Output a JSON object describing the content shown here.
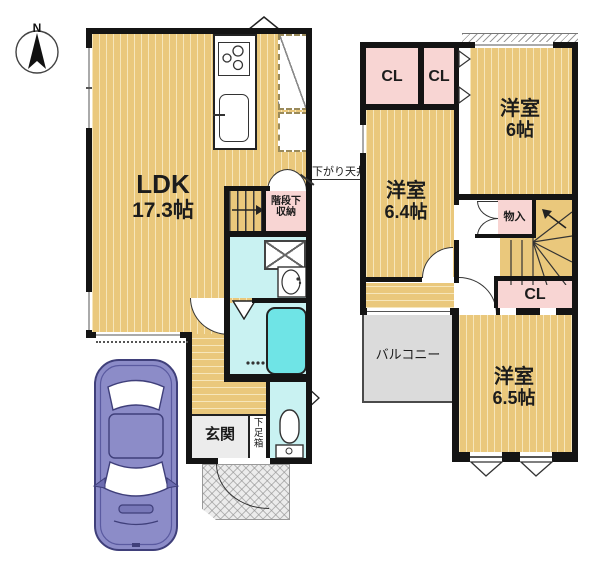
{
  "compass": {
    "north_label": "N"
  },
  "floor1": {
    "ldk": {
      "name": "LDK",
      "area": "17.3帖"
    },
    "lowered_ceiling_note": "下がり天井",
    "under_stair_storage": {
      "line1": "階段下",
      "line2": "収納"
    },
    "entrance_label": "玄関",
    "shoe_cabinet_label": "下足箱"
  },
  "floor2": {
    "closet_a_label": "CL",
    "closet_b_label": "CL",
    "closet_c_label": "CL",
    "storage_label": "物入",
    "room_a": {
      "name": "洋室",
      "area": "6帖"
    },
    "room_b": {
      "name": "洋室",
      "area": "6.4帖"
    },
    "room_c": {
      "name": "洋室",
      "area": "6.5帖"
    },
    "balcony_label": "バルコニー"
  },
  "colors": {
    "floor_tan": "#EAC87C",
    "closet_pink": "#F8D5D3",
    "wet_area_cyan": "#C9F2F2",
    "bathtub_cyan": "#6FE4E6",
    "balcony_gray": "#DBDBDB",
    "porch_gray": "#ECECEC",
    "car_body_purple": "#8C8CC8",
    "wall_black": "#141414"
  }
}
